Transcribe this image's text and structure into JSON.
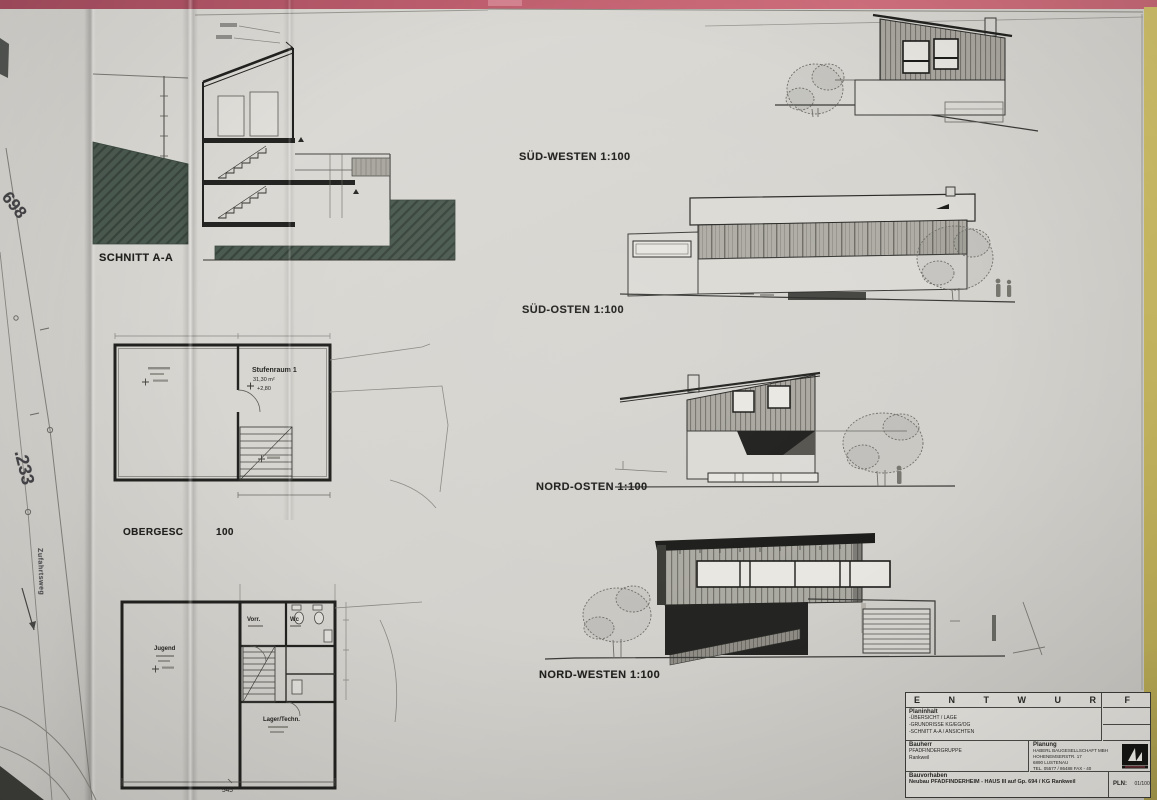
{
  "colors": {
    "desk": "#c05f6f",
    "paper": "#d8d6d1",
    "edge_strip": "#c9ba62",
    "earth_hatch": "#4c5b51",
    "siding_gray": "#a9a79f",
    "ink": "#262624"
  },
  "site_plan": {
    "parcel_698": "698",
    "parcel_233": ".233",
    "road_label": "Zufahrtsweg"
  },
  "section": {
    "label": "SCHNITT A-A"
  },
  "upper_floor_plan": {
    "label": "OBERGESC",
    "scale": "100",
    "room": {
      "name": "Stufenraum 1",
      "area": "31,30 m²",
      "level": "+2,80"
    }
  },
  "ground_floor_plan": {
    "rooms": {
      "vorraum": "Vorr.",
      "wc": "Wc",
      "lager": "Lager/Techn.",
      "jugend": "Jugend"
    },
    "dim_width": "545"
  },
  "elevations": [
    {
      "label": "SÜD-WESTEN 1:100"
    },
    {
      "label": "SÜD-OSTEN 1:100"
    },
    {
      "label": "NORD-OSTEN 1:100"
    },
    {
      "label": "NORD-WESTEN 1:100"
    }
  ],
  "title_block": {
    "header": "E N T W U R F",
    "plan_content_label": "Planinhalt",
    "plan_content_lines": [
      "-ÜBERSICHT / LAGE",
      "-GRUNDRISSE KG/EG/OG",
      "-SCHNITT A-A / ANSICHTEN"
    ],
    "client_label": "Bauherr",
    "client_line1": "PFADFINDERGRUPPE",
    "client_line2": "Rankweil",
    "planner_label": "Planung",
    "planner_lines": [
      "HABERL BAUGESELLSCHAFT MBH",
      "HOHENEMSERSTR. 17",
      "6890 LUSTENAU",
      "TEL. 05577 / 86488 FAX - 40"
    ],
    "project_label": "Bauvorhaben",
    "project_text": "Neubau PFADFINDERHEIM - HAUS III auf Gp. 694 / KG Rankweil",
    "plan_no_label": "PLN:",
    "plan_no_value": "01/100"
  }
}
